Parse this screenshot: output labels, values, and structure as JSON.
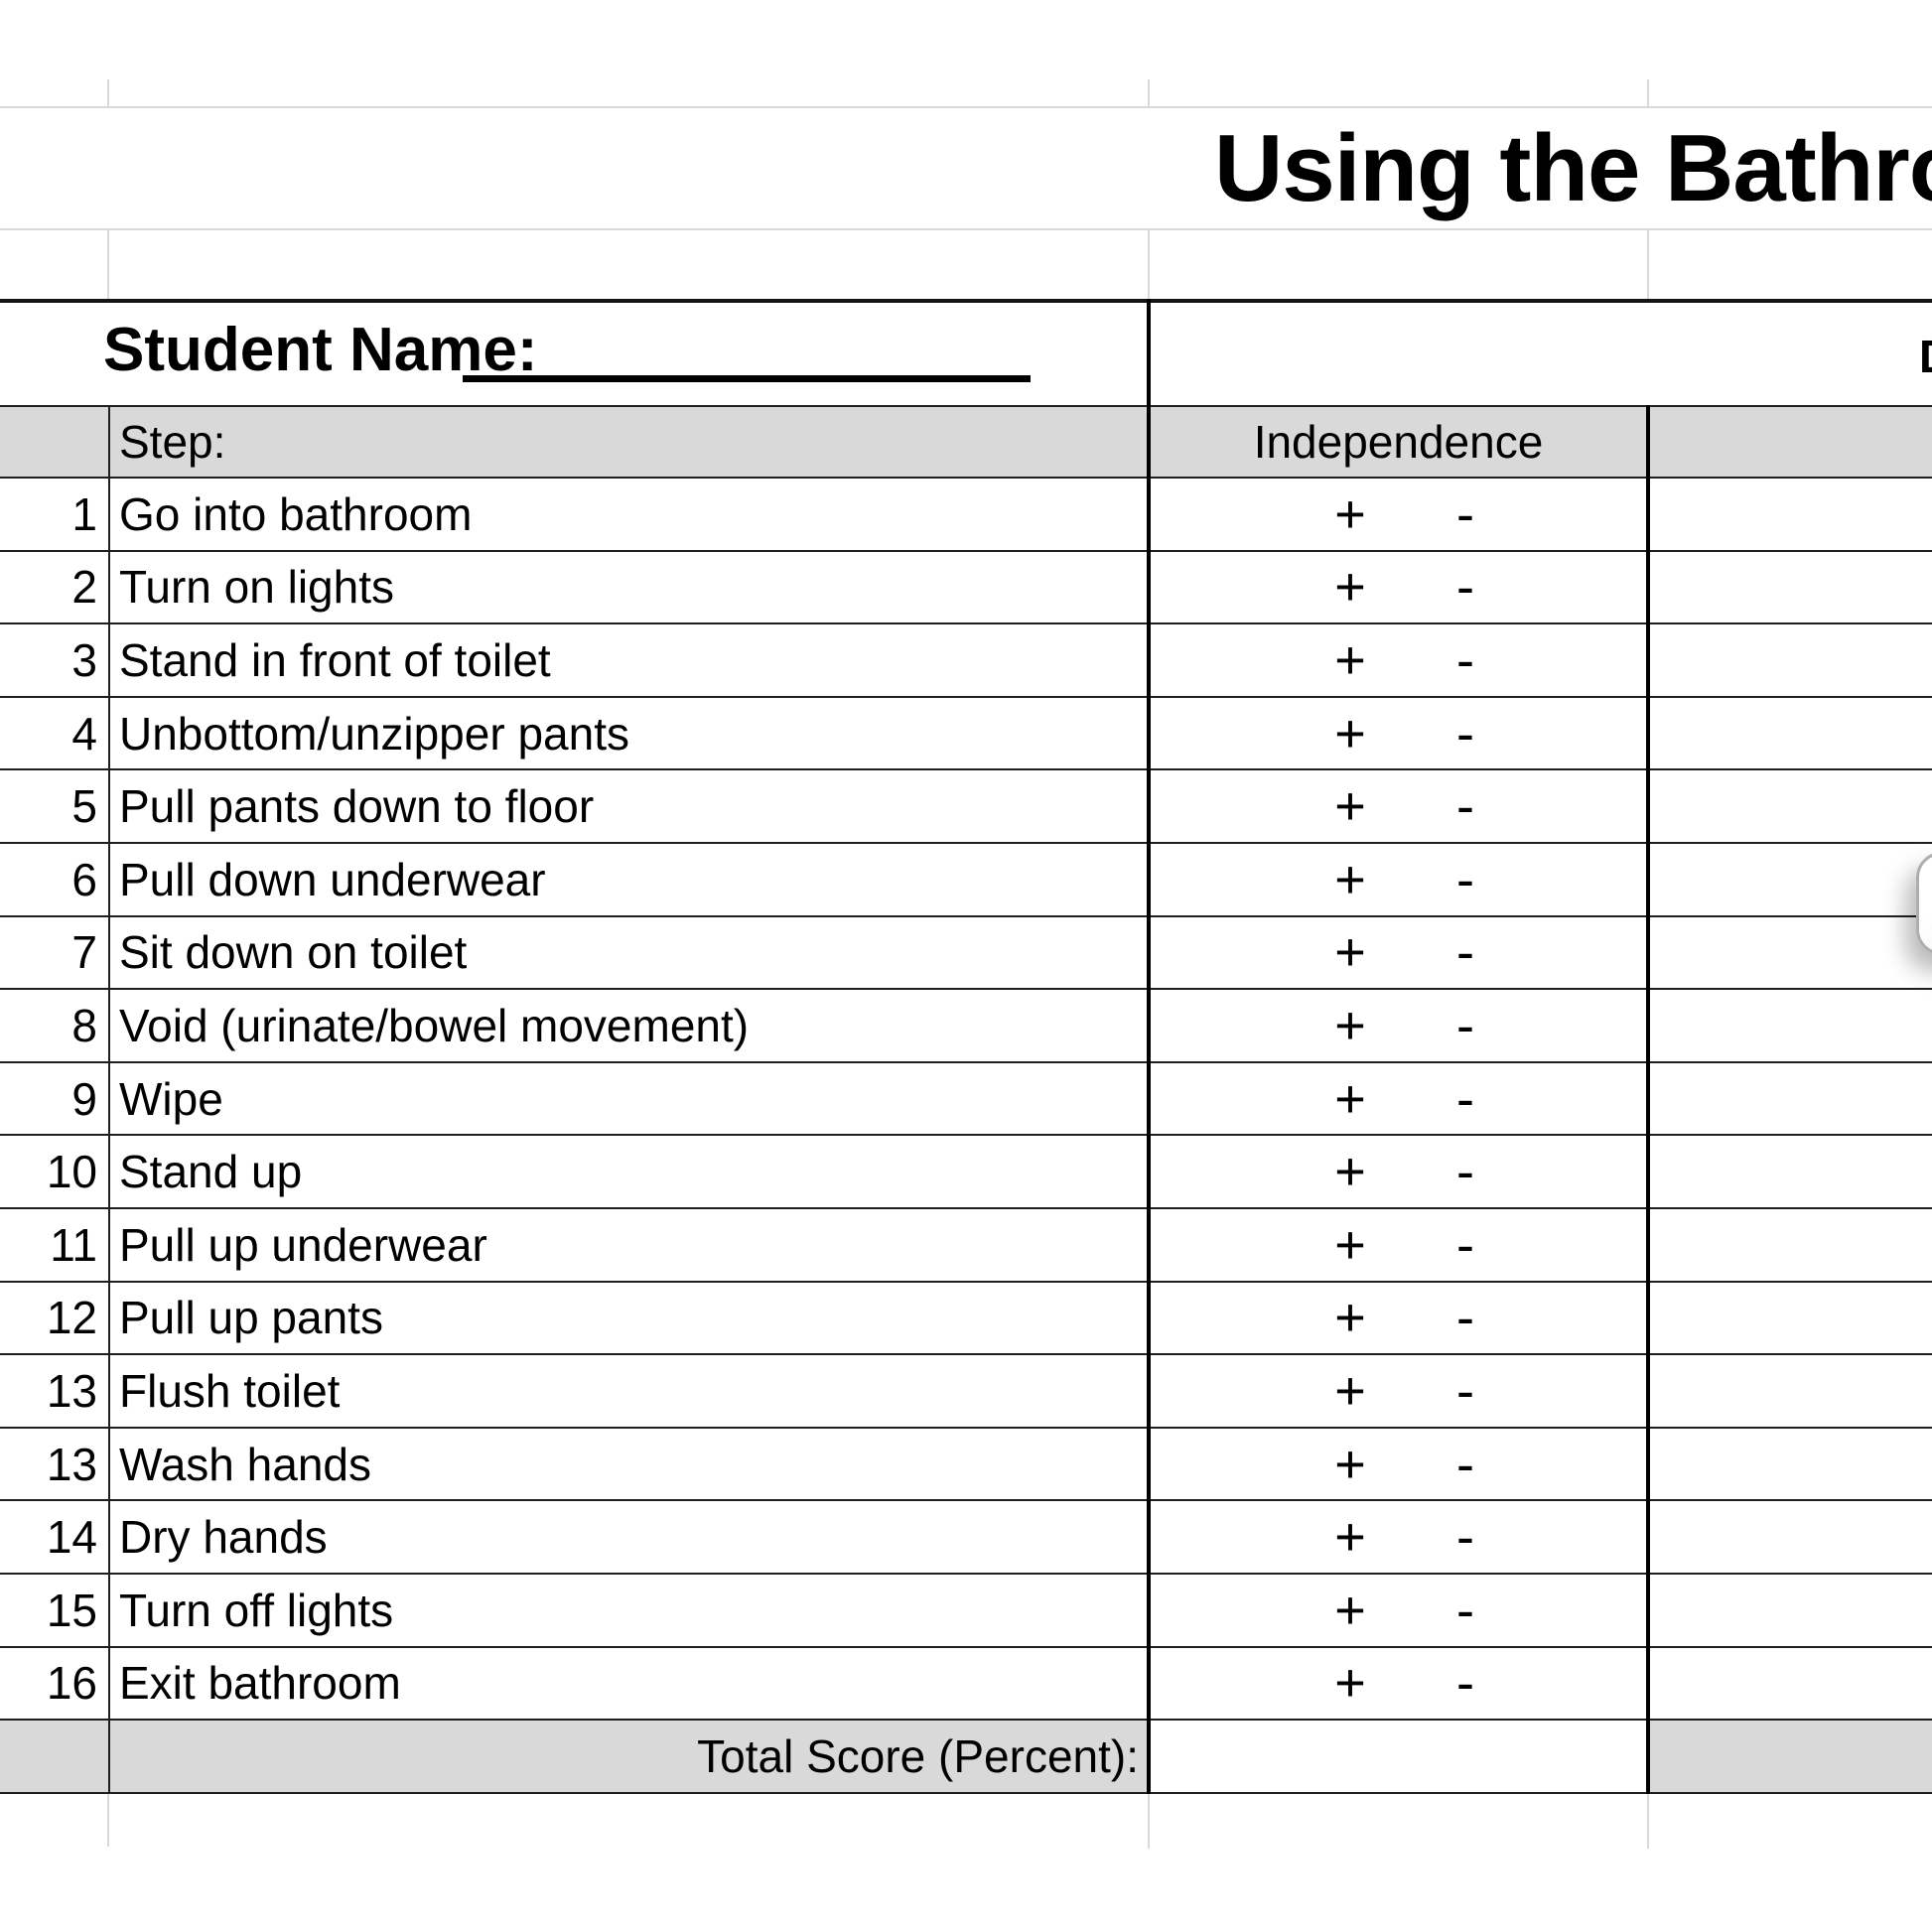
{
  "sheet": {
    "title": "Using the Bathroom",
    "student": {
      "label": "Student Name:",
      "value": ""
    },
    "date": {
      "label": "Date:",
      "value": ""
    },
    "columns": {
      "step": "Step:",
      "independence": "Independence"
    },
    "marks": {
      "plus": "+",
      "minus": "-"
    },
    "steps": [
      {
        "num": "1",
        "text": "Go into bathroom"
      },
      {
        "num": "2",
        "text": "Turn on lights"
      },
      {
        "num": "3",
        "text": "Stand in front of toilet"
      },
      {
        "num": "4",
        "text": "Unbottom/unzipper pants"
      },
      {
        "num": "5",
        "text": "Pull pants down to floor"
      },
      {
        "num": "6",
        "text": "Pull down underwear"
      },
      {
        "num": "7",
        "text": "Sit down on toilet"
      },
      {
        "num": "8",
        "text": "Void (urinate/bowel movement)"
      },
      {
        "num": "9",
        "text": "Wipe"
      },
      {
        "num": "10",
        "text": "Stand up"
      },
      {
        "num": "11",
        "text": "Pull up underwear"
      },
      {
        "num": "12",
        "text": "Pull up pants"
      },
      {
        "num": "13",
        "text": "Flush toilet"
      },
      {
        "num": "13",
        "text": "Wash hands"
      },
      {
        "num": "14",
        "text": "Dry hands"
      },
      {
        "num": "15",
        "text": "Turn off lights"
      },
      {
        "num": "16",
        "text": "Exit bathroom"
      }
    ],
    "total": {
      "label": "Total Score (Percent):",
      "value": ""
    },
    "colors": {
      "header_fill": "#d9d9d9",
      "table_border": "#1f1f1f",
      "thick_border": "#000000",
      "gridline": "#d9d9d9",
      "text": "#000000"
    }
  }
}
